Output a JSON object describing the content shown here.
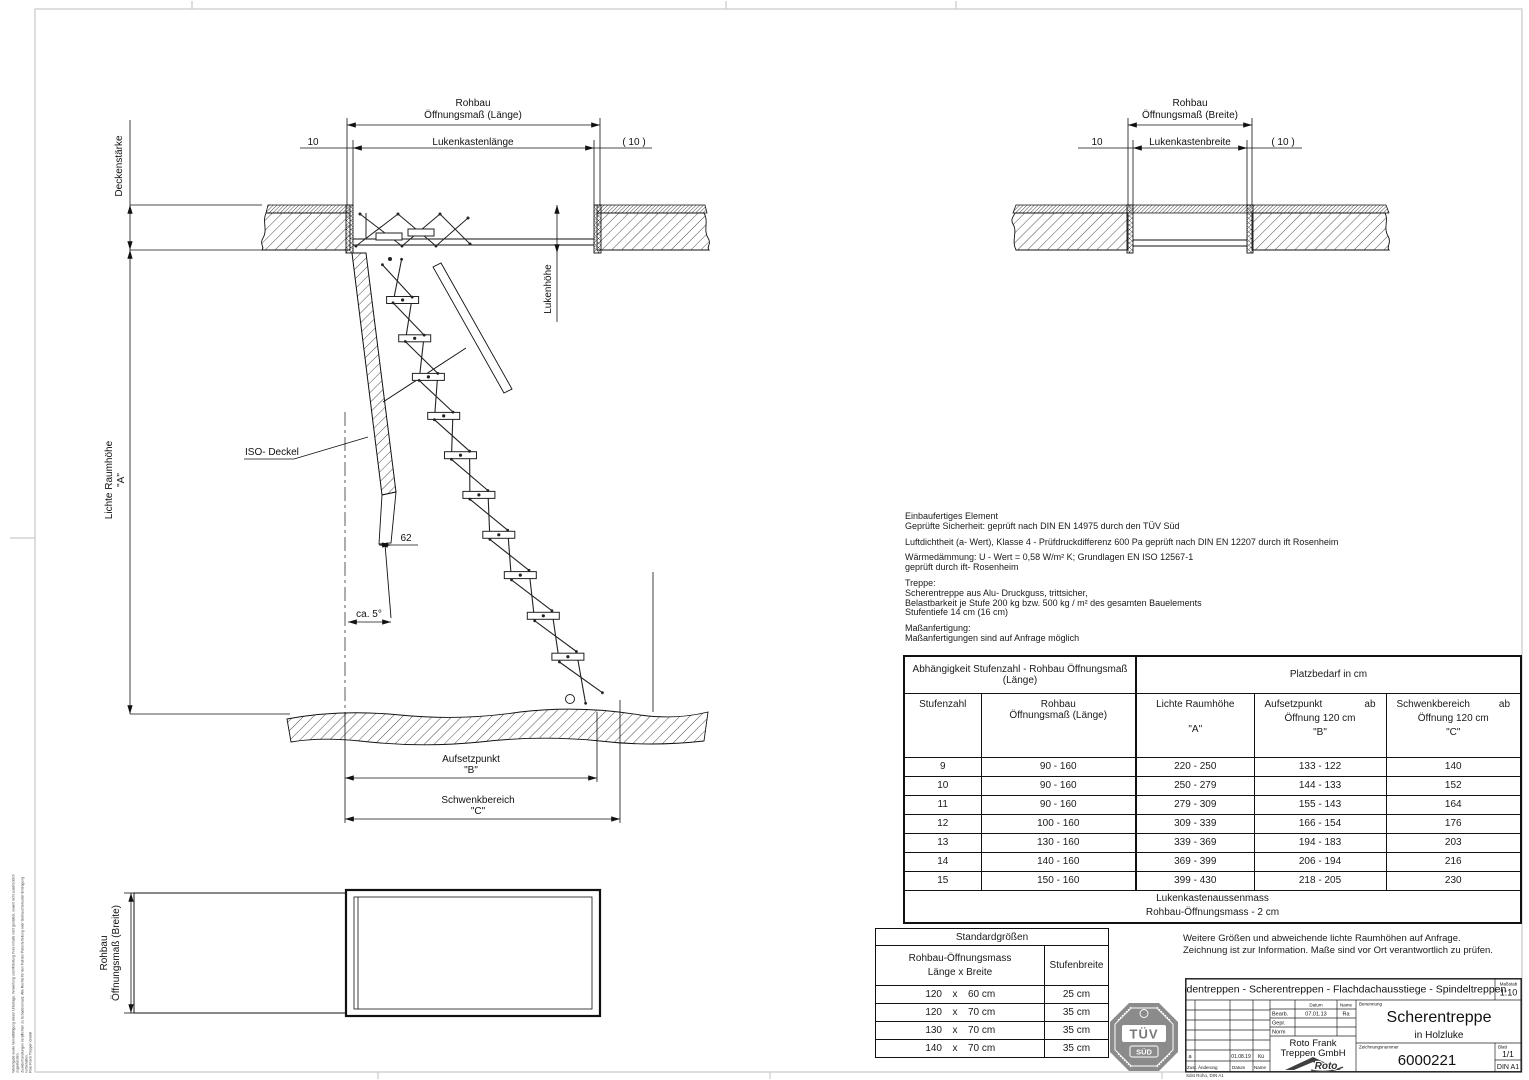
{
  "view_length": {
    "dim_rohbau_l1": "Rohbau",
    "dim_rohbau_l2": "Öffnungsmaß (Länge)",
    "dim_10": "10",
    "dim_luken": "Lukenkastenlänge",
    "dim_10_paren": "( 10 )",
    "deckenstaerke": "Deckenstärke",
    "lichte_raumhoehe_l1": "Lichte Raumhöhe",
    "lichte_raumhoehe_l2": "\"A\"",
    "lukenhoehe": "Lukenhöhe",
    "iso_deckel": "ISO- Deckel",
    "dim_62": "62",
    "dim_ca5": "ca. 5°",
    "aufsetzpunkt_l1": "Aufsetzpunkt",
    "aufsetzpunkt_l2": "\"B\"",
    "schwenkbereich_l1": "Schwenkbereich",
    "schwenkbereich_l2": "\"C\""
  },
  "view_width": {
    "dim_rohbau_l1": "Rohbau",
    "dim_rohbau_l2": "Öffnungsmaß (Breite)",
    "dim_10": "10",
    "dim_luken": "Lukenkastenbreite",
    "dim_10_paren": "( 10 )"
  },
  "plan_view": {
    "dim_l1": "Rohbau",
    "dim_l2": "Öffnungsmaß (Breite)"
  },
  "specs": {
    "lines": [
      "Einbaufertiges Element",
      "Geprüfte Sicherheit: geprüft nach DIN EN 14975 durch den TÜV Süd",
      "Luftdichtheit (a- Wert), Klasse 4 - Prüfdruckdifferenz 600 Pa geprüft nach DIN EN 12207 durch ift Rosenheim",
      "Wärmedämmung: U - Wert = 0,58 W/m² K; Grundlagen EN ISO 12567-1",
      "geprüft durch ift- Rosenheim",
      "Treppe:",
      "Scherentreppe aus Alu- Druckguss, trittsicher,",
      "Belastbarkeit je Stufe 200 kg bzw. 500 kg / m² des gesamten Bauelements",
      "Stufentiefe 14 cm (16 cm)",
      "Maßanfertigung:",
      "Maßanfertigungen sind auf Anfrage möglich"
    ]
  },
  "main_table": {
    "header_left_l1": "Abhängigkeit Stufenzahl - Rohbau Öffnungsmaß",
    "header_left_l2": "(Länge)",
    "header_right": "Platzbedarf in cm",
    "col1": "Stufenzahl",
    "col2_l1": "Rohbau",
    "col2_l2": "Öffnungsmaß (Länge)",
    "col3_l1": "Lichte Raumhöhe",
    "col3_l2": "\"A\"",
    "col4_w1": "Aufsetzpunkt",
    "col4_w2": "ab",
    "col4_l2": "Öffnung 120 cm",
    "col4_l3": "\"B\"",
    "col5_w1": "Schwenkbereich",
    "col5_w2": "ab",
    "col5_l2": "Öffnung 120 cm",
    "col5_l3": "\"C\"",
    "rows": [
      [
        "9",
        "90 - 160",
        "220 - 250",
        "133 - 122",
        "140"
      ],
      [
        "10",
        "90 - 160",
        "250 - 279",
        "144 - 133",
        "152"
      ],
      [
        "11",
        "90 - 160",
        "279 - 309",
        "155 - 143",
        "164"
      ],
      [
        "12",
        "100 - 160",
        "309 - 339",
        "166 - 154",
        "176"
      ],
      [
        "13",
        "130 - 160",
        "339 - 369",
        "194 - 183",
        "203"
      ],
      [
        "14",
        "140 - 160",
        "369 - 399",
        "206 - 194",
        "216"
      ],
      [
        "15",
        "150 - 160",
        "399 - 430",
        "218 - 205",
        "230"
      ]
    ],
    "footer_l1": "Lukenkastenaussenmass",
    "footer_l2": "Rohbau-Öffnungsmass - 2 cm"
  },
  "std_table": {
    "title": "Standardgrößen",
    "col1_l1": "Rohbau-Öffnungsmass",
    "col1_l2": "Länge x Breite",
    "col2": "Stufenbreite",
    "rows": [
      [
        "120",
        "x",
        "60 cm",
        "25 cm"
      ],
      [
        "120",
        "x",
        "70 cm",
        "35 cm"
      ],
      [
        "130",
        "x",
        "70 cm",
        "35 cm"
      ],
      [
        "140",
        "x",
        "70 cm",
        "35 cm"
      ]
    ]
  },
  "notes": {
    "line1": "Weitere Größen und abweichende lichte Raumhöhen auf Anfrage.",
    "line2": "Zeichnung ist zur Information. Maße sind vor Ort verantwortlich zu prüfen."
  },
  "tuev": {
    "l1": "TÜV",
    "l2": "SÜD"
  },
  "title_block": {
    "product_line": "Bodentreppen - Scherentreppen - Flachdachausstiege - Spindeltreppen",
    "massstab_label": "Maßstab",
    "massstab": "1:10",
    "datum_label": "Datum",
    "name_label": "Name",
    "bearb_label": "Bearb.",
    "bearb_datum": "07.01.13",
    "bearb_name": "Ra",
    "gepr_label": "Gepr.",
    "norm_label": "Norm",
    "company_l1": "Roto Frank",
    "company_l2": "Treppen GmbH",
    "logo_text": "Roto",
    "benennung_label": "Benennung",
    "title_l1": "Scherentreppe",
    "title_l2": "in Holzluke",
    "zeichnungsnummer_label": "Zeichnungsnummer",
    "drawing_number": "6000221",
    "blatt_label": "Blatt",
    "blatt": "1/1",
    "format": "DIN A1",
    "rev_index": "a",
    "rev_datum": "01.08.19",
    "rev_name": "Kü",
    "zust_label": "Zust.",
    "aenderung_label": "Änderung",
    "datum2_label": "Datum",
    "name2_label": "Name",
    "footnote": "Sdst Roho, DIN A1"
  },
  "margin_note": {
    "l1": "Weitergabe sowie Vervielfältigung dieser Unterlage, Verwertung und Mitteilung ihres Inhalts nicht gestattet, soweit nicht ausdrücklich zugestanden.",
    "l2": "Zuwiderhandlungen verpflichten zu Schadenersatz. Alle Rechte für den Fall der Patenterteilung oder Gebrauchsmuster-Eintragung vorbehalten.",
    "l3": "Roto Frank Treppen GmbH"
  }
}
